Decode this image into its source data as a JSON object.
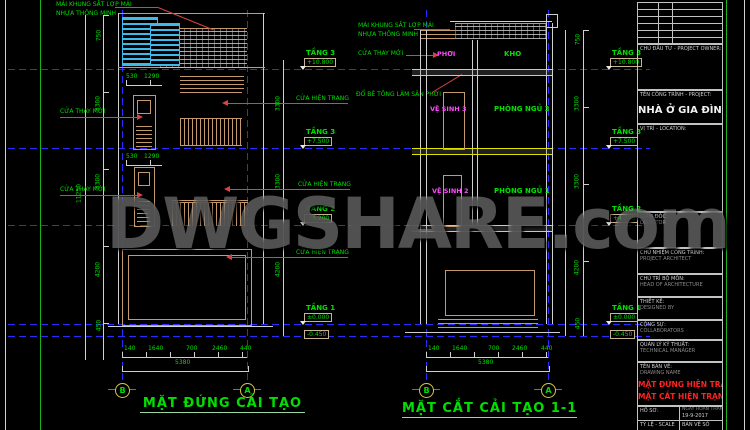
{
  "watermark": {
    "text": "DWGSHARE.com"
  },
  "colors": {
    "background": "#000000",
    "level_line_blue": "#2b2bff",
    "building_tan": "#c49a6c",
    "text_green": "#00dd00",
    "text_magenta": "#ff4dff",
    "titleblock_red": "#ff2222",
    "louver_cyan": "#3fb8ea",
    "slab_yellow": "#e2e200"
  },
  "left": {
    "title": "MẶT ĐỨNG CẢI TẠO",
    "note_roof_line1": "MÁI KHUNG SẮT LỢP MÁI",
    "note_roof_line2": "NHỰA THÔNG MINH",
    "label_new_door": "CỬA THAY MỚI",
    "label_existing_door": "CỬA HIỆN TRẠNG",
    "levels": [
      {
        "name": "TẦNG 3",
        "value": "+10.800"
      },
      {
        "name": "TẦNG 3",
        "value": "+7.500"
      },
      {
        "name": "TẦNG 2",
        "value": "+4.200"
      },
      {
        "name": "TẦNG 1",
        "value": "±0.000"
      }
    ],
    "base_value": "-0.450",
    "door_dims": [
      "530",
      "1290"
    ],
    "vdims": [
      "750",
      "3300",
      "3300",
      "4200",
      "450"
    ],
    "vdim_total": "11250",
    "dims": [
      "140",
      "1640",
      "700",
      "2460",
      "440"
    ],
    "dim_total": "5380",
    "grid_left": "B",
    "grid_right": "A"
  },
  "right": {
    "title": "MẶT CẮT CẢI TẠO 1-1",
    "note_roof_line1": "MÁI KHUNG SẮT LỢP MÁI",
    "note_roof_line2": "NHỰA THÔNG MINH",
    "note_new_door": "CỬA THAY MỚI",
    "note_concrete": "ĐỔ BÊ TÔNG LÀM SÂN PHƠI",
    "rooms": {
      "phoi": "PHƠI",
      "kho": "KHO",
      "vs3": "VỆ SINH 3",
      "pn3": "PHÒNG NGỦ 3",
      "vs2": "VỆ SINH 2",
      "pn1": "PHÒNG NGỦ 1"
    },
    "levels": [
      {
        "name": "TẦNG 3",
        "value": "+10.800"
      },
      {
        "name": "TẦNG 3",
        "value": "+7.500"
      },
      {
        "name": "TẦNG 2",
        "value": "+4.200"
      },
      {
        "name": "TẦNG 1",
        "value": "±0.000"
      }
    ],
    "base_value": "-0.450",
    "vdims": [
      "750",
      "3300",
      "3300",
      "4200",
      "450"
    ],
    "dims": [
      "140",
      "1640",
      "700",
      "2460",
      "440"
    ],
    "dim_total": "5380",
    "grid_left": "B",
    "grid_right": "A"
  },
  "title_block": {
    "owner_label": "CHỦ ĐẦU TƯ - PROJECT OWNER:",
    "project_label": "TÊN CÔNG TRÌNH - PROJECT:",
    "project_name": "NHÀ Ở GIA ĐÌNH",
    "location_label": "VỊ TRÍ - LOCATION:",
    "rows": [
      {
        "label": "GIÁM ĐỐC:",
        "sub": "DIRECTOR"
      },
      {
        "label": "CHỦ NHIỆM CÔNG TRÌNH:",
        "sub": "PROJECT ARCHITECT"
      },
      {
        "label": "CHỦ TRÌ BỘ MÔN:",
        "sub": "HEAD OF ARCHITECTURE"
      },
      {
        "label": "THIẾT KẾ:",
        "sub": "DESIGNED BY"
      },
      {
        "label": "CỘNG SỰ:",
        "sub": "COLLABORATORS"
      },
      {
        "label": "QUẢN LÝ KỸ THUẬT:",
        "sub": "TECHNICAL MANAGER"
      }
    ],
    "drawing_name_label": "TÊN BẢN VẼ:",
    "drawing_name_sub": "DRAWING NAME",
    "drawing_names": [
      "MẶT ĐỨNG HIỆN TRẠNG",
      "MẶT CẮT HIỆN TRẠNG"
    ],
    "bottom": {
      "ho_so_label": "HỒ SƠ:",
      "date_label": "NGÀY HOÀN THÀNH",
      "date_value": "19-9-2017",
      "scale_label": "TỶ LỆ - SCALE",
      "sheet_label": "BẢN VẼ SỐ"
    }
  }
}
